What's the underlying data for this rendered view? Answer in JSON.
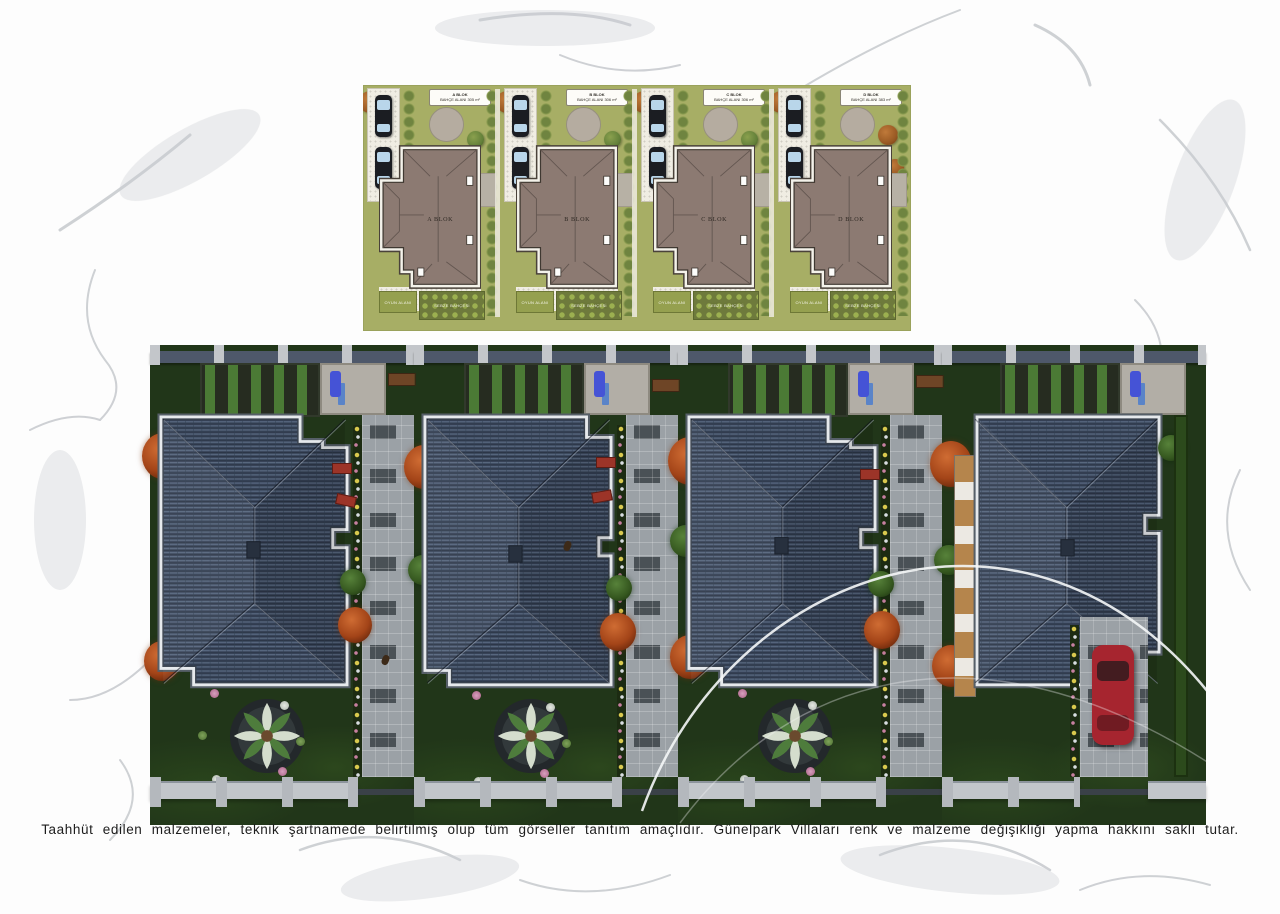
{
  "page": {
    "disclaimer": "Taahhüt edilen malzemeler, teknik şartnamede belirtilmiş olup tüm görseller tanıtım amaçlıdır.  Günelpark Villaları renk ve malzeme değişikliği yapma hakkını saklı tutar."
  },
  "site_plan": {
    "blocks": [
      {
        "name": "A BLOK",
        "label_title": "A BLOK",
        "label_area": "BAHÇE ALANI 305 m²"
      },
      {
        "name": "B BLOK",
        "label_title": "B BLOK",
        "label_area": "BAHÇE ALANI 306 m²"
      },
      {
        "name": "C BLOK",
        "label_title": "C BLOK",
        "label_area": "BAHÇE ALANI 306 m²"
      },
      {
        "name": "D BLOK",
        "label_title": "D BLOK",
        "label_area": "BAHÇE ALANI 383 m²"
      }
    ],
    "ground_labels": {
      "play_area": "OYUN ALANI",
      "vegetable_garden": "SEBZE BAHÇESİ"
    }
  },
  "colors": {
    "plan_lawn": "#a7ae65",
    "plan_roof": "#8c7a72",
    "plan_path": "#f0ede3",
    "plan_circle": "#b5aca0",
    "render_grass": "#22371a",
    "render_roof": "#3a4657",
    "render_parapet": "#e6e9ec",
    "render_paving": "#9ba1a6",
    "tree_orange": "#a34418",
    "tree_green": "#35571f",
    "car_red": "#a6252f",
    "arc_white": "#f5f6f7"
  }
}
